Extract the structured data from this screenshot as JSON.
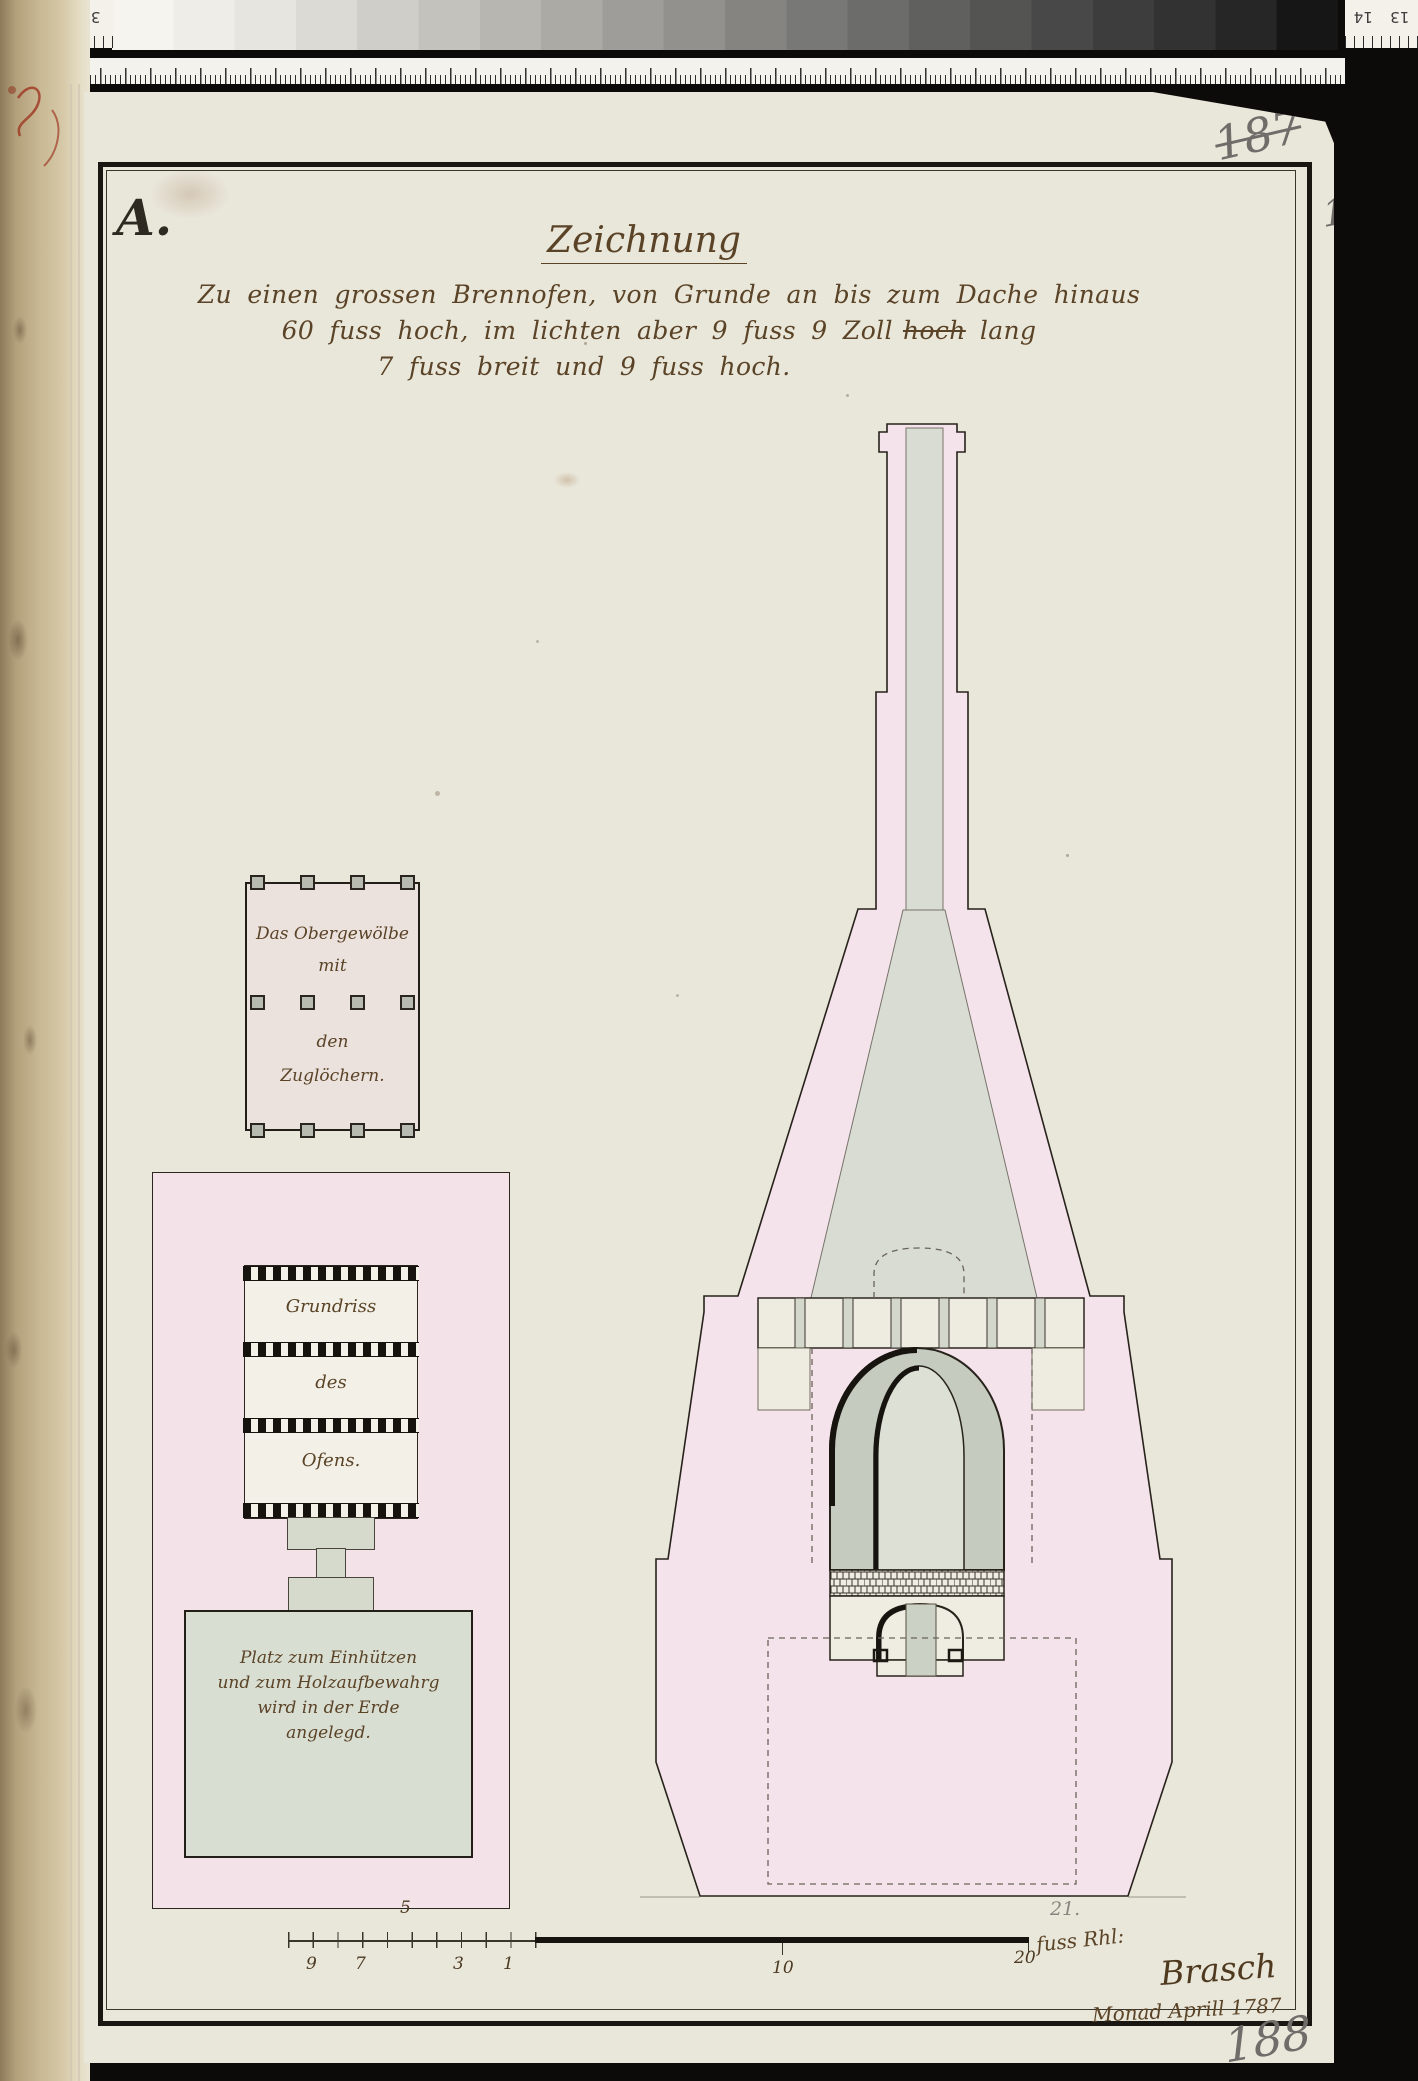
{
  "scan": {
    "left_ruler": {
      "n1": "36",
      "n2": "35"
    },
    "right_ruler": {
      "n1": "14",
      "n2": "13"
    }
  },
  "annotations": {
    "letter_a": "A.",
    "page_187": "187",
    "page_188_top": "188",
    "page_188_bottom": "188",
    "pencil_21": "21."
  },
  "title_block": {
    "title": "Zeichnung",
    "line1": "Zu einen grossen Brennofen, von Grunde an bis zum Dache hinaus",
    "line2_a": "60 fuss hoch, im lichten aber 9 fuss 9 Zoll",
    "line2_struck": "hoch",
    "line2_b": "lang",
    "line3": "7 fuss breit und 9 fuss hoch."
  },
  "upper_plan": {
    "l1": "Das Obergewölbe",
    "l2": "mit",
    "l3": "den",
    "l4": "Zuglöchern."
  },
  "lower_plan": {
    "l1": "Grundriss",
    "l2": "des",
    "l3": "Ofens.",
    "pit1": "Platz zum Einhützen",
    "pit2": "und zum Holzaufbewahrg",
    "pit3": "wird in der Erde",
    "pit4": "angelegd."
  },
  "scale_bar": {
    "top": "5",
    "s9": "9",
    "s7": "7",
    "s3": "3",
    "s1": "1",
    "m10": "10",
    "m20": "20",
    "unit": "fuss Rhl:"
  },
  "signature": {
    "name": "Brasch",
    "date": "Monad Aprill 1787"
  },
  "colors": {
    "paper": "#e9e6da",
    "pink_wash": "#f5e3eb",
    "gray_wash": "#d8dcd2",
    "ink": "#27221b",
    "hand_ink": "#5a4326",
    "pencil": "#6f6d69"
  }
}
